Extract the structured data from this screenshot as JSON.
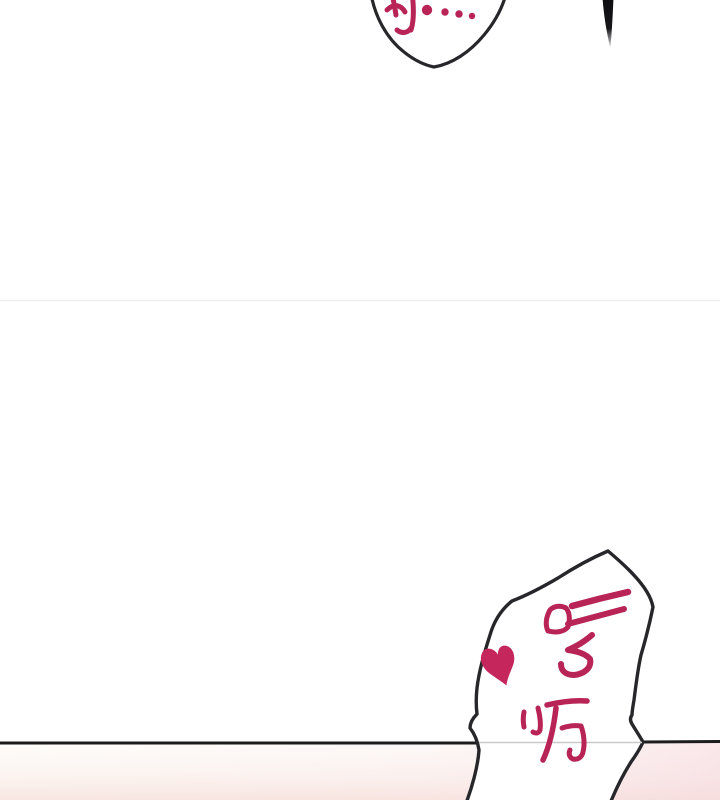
{
  "page": {
    "width": 720,
    "height": 800,
    "background": "#ffffff"
  },
  "speech": {
    "top_bubble": {
      "text": "阿…",
      "trailing_dots": 3
    },
    "bottom_bubble": {
      "text": "哼呃",
      "heart": "♥"
    }
  },
  "colors": {
    "ink": "#b82455",
    "heart": "#c5275d",
    "outline": "#27272b",
    "line": "#1c1c1c",
    "inner_line": "#c9c9c9",
    "faint_divider": "#ededed",
    "tint_bottom": "#f7e2de",
    "tint_right": "#f6d8dd",
    "hair": "#101013"
  }
}
